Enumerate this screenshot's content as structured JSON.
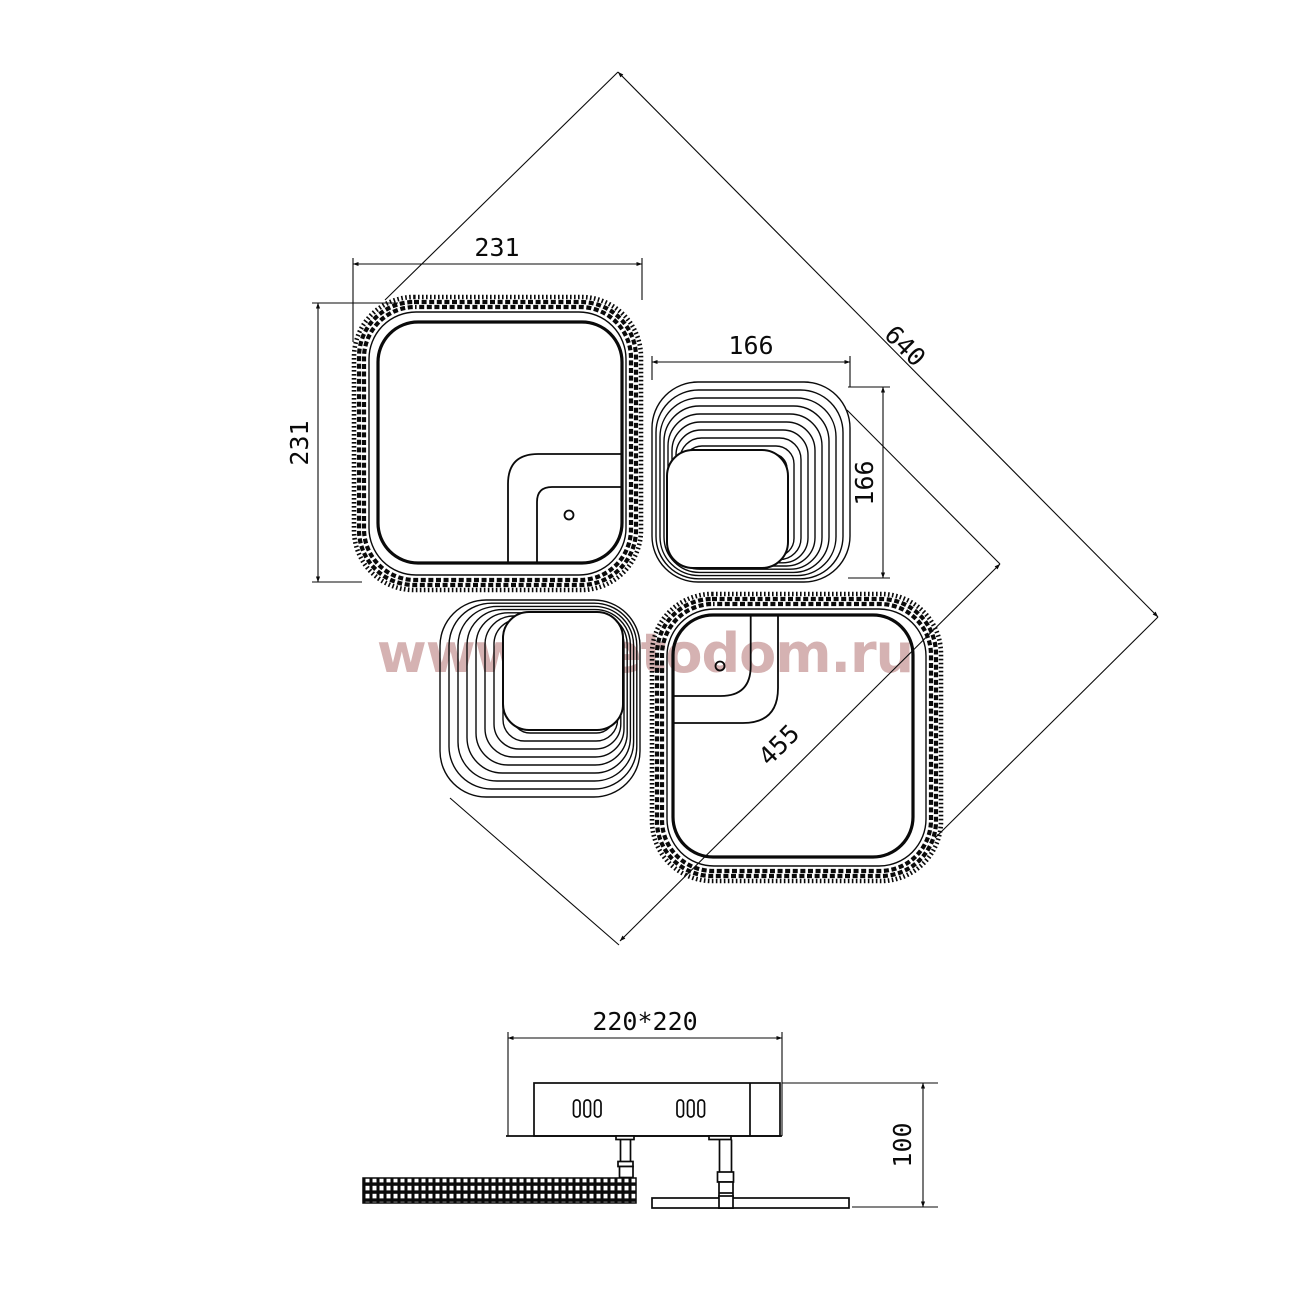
{
  "drawing": {
    "watermark": "www.svetodom.ru",
    "plan": {
      "dim_width_top_left": "231",
      "dim_height_top_left": "231",
      "dim_width_top_right": "166",
      "dim_height_top_right": "166",
      "dim_diagonal_overall": "640",
      "dim_diagonal_large_square": "455"
    },
    "side": {
      "dim_canopy": "220*220",
      "dim_height": "100"
    },
    "colors": {
      "line": "#0a0a0a",
      "watermark": "#cb9f9f",
      "background": "#ffffff"
    }
  }
}
